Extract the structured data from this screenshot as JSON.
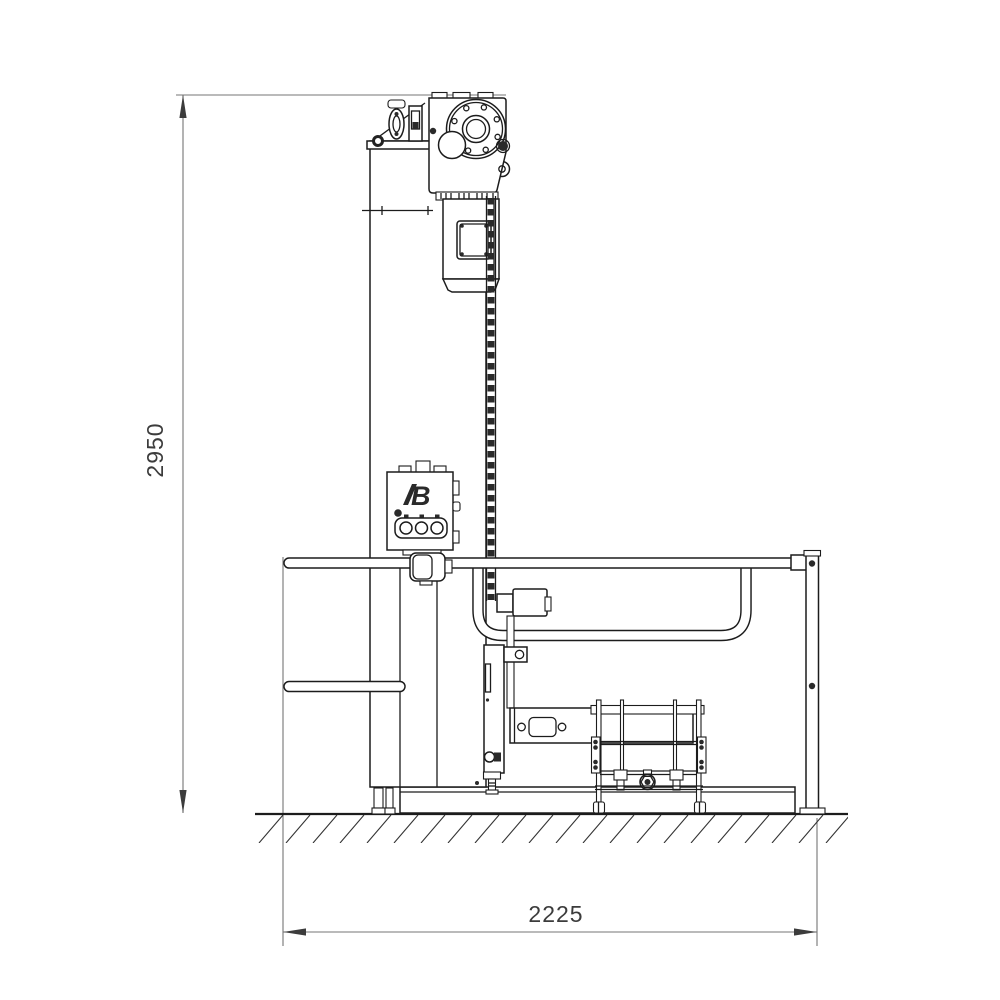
{
  "drawing": {
    "dimensions": {
      "height_label": "2950",
      "width_label": "2225"
    },
    "logo_text": "B",
    "colors": {
      "line": "#1c1c1c",
      "detail": "#2a2a2a",
      "dim_line": "#757575",
      "dim_text": "#3c3c3c",
      "background": "#ffffff"
    }
  }
}
